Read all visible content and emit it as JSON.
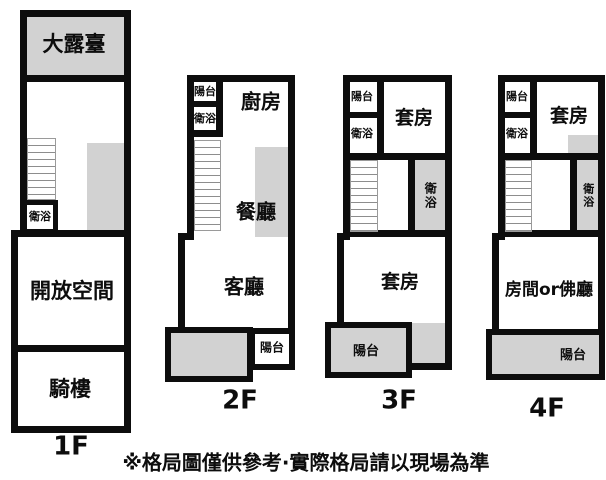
{
  "colors": {
    "wall": "#0d0d0d",
    "gray_fill": "#d2d2d2",
    "background": "#ffffff"
  },
  "caption": "※格局圖僅供參考·實際格局請以現場為準",
  "floors": {
    "f1": {
      "label": "1F",
      "terrace": "大露臺",
      "bath": "衛浴",
      "open_space": "開放空間",
      "arcade": "騎樓"
    },
    "f2": {
      "label": "2F",
      "balcony_top": "陽台",
      "bath_top": "衛浴",
      "kitchen": "廚房",
      "dining": "餐廳",
      "living": "客廳",
      "balcony_bottom": "陽台"
    },
    "f3": {
      "label": "3F",
      "balcony_top": "陽台",
      "bath_top": "衛浴",
      "suite_top": "套房",
      "bath_mid": "衛浴",
      "suite_main": "套房",
      "balcony_bottom": "陽台"
    },
    "f4": {
      "label": "4F",
      "balcony_top": "陽台",
      "bath_top": "衛浴",
      "suite_top": "套房",
      "bath_mid": "衛浴",
      "main_room": "房間or佛廳",
      "balcony_bottom": "陽台"
    }
  }
}
